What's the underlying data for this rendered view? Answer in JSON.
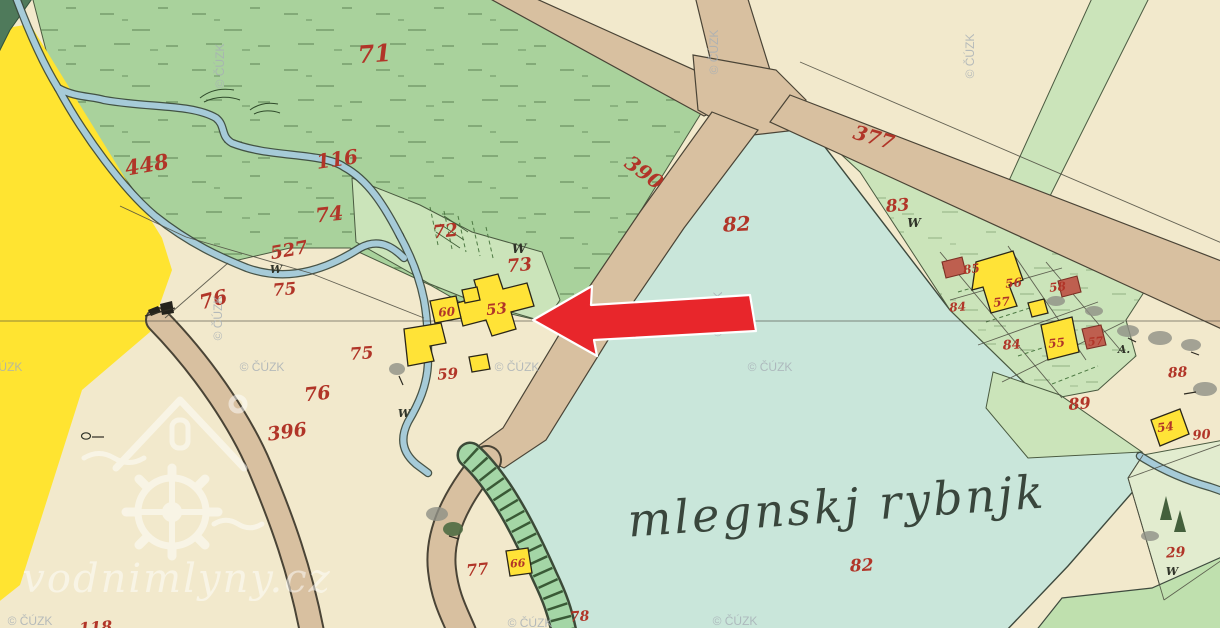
{
  "map": {
    "pond_name": "mlegnskj rybnjk",
    "type_note": "historic hand-colored cadastral map sheet"
  },
  "labels": [
    {
      "t": "71",
      "x": 375,
      "y": 62,
      "s": 24,
      "r": -4
    },
    {
      "t": "448",
      "x": 148,
      "y": 172,
      "s": 21,
      "r": -10
    },
    {
      "t": "116",
      "x": 338,
      "y": 166,
      "s": 20,
      "r": -8
    },
    {
      "t": "74",
      "x": 330,
      "y": 221,
      "s": 20,
      "r": -6
    },
    {
      "t": "527",
      "x": 290,
      "y": 256,
      "s": 18,
      "r": -10
    },
    {
      "t": "72",
      "x": 446,
      "y": 237,
      "s": 18,
      "r": -6
    },
    {
      "t": "W",
      "x": 519,
      "y": 253,
      "s": 13,
      "r": 0,
      "c": "ink"
    },
    {
      "t": "73",
      "x": 520,
      "y": 271,
      "s": 18,
      "r": -5
    },
    {
      "t": "390",
      "x": 640,
      "y": 178,
      "s": 20,
      "r": 36
    },
    {
      "t": "377",
      "x": 872,
      "y": 144,
      "s": 20,
      "r": 16
    },
    {
      "t": "82",
      "x": 737,
      "y": 231,
      "s": 20,
      "r": -3
    },
    {
      "t": "83",
      "x": 898,
      "y": 211,
      "s": 17,
      "r": -5
    },
    {
      "t": "W",
      "x": 914,
      "y": 227,
      "s": 12,
      "r": 0,
      "c": "ink"
    },
    {
      "t": "76",
      "x": 215,
      "y": 306,
      "s": 20,
      "r": -14
    },
    {
      "t": "W",
      "x": 276,
      "y": 273,
      "s": 11,
      "r": 0,
      "c": "ink"
    },
    {
      "t": "75",
      "x": 285,
      "y": 295,
      "s": 17,
      "r": -5
    },
    {
      "t": "75",
      "x": 362,
      "y": 359,
      "s": 17,
      "r": -4
    },
    {
      "t": "76",
      "x": 318,
      "y": 400,
      "s": 19,
      "r": -6
    },
    {
      "t": "396",
      "x": 288,
      "y": 438,
      "s": 19,
      "r": -8
    },
    {
      "t": "W",
      "x": 404,
      "y": 417,
      "s": 11,
      "r": 0,
      "c": "ink"
    },
    {
      "t": "60",
      "x": 447,
      "y": 316,
      "s": 12,
      "r": -4
    },
    {
      "t": "53",
      "x": 497,
      "y": 314,
      "s": 15,
      "r": -6
    },
    {
      "t": "59",
      "x": 448,
      "y": 379,
      "s": 15,
      "r": -4
    },
    {
      "t": "85",
      "x": 972,
      "y": 273,
      "s": 12,
      "r": -8
    },
    {
      "t": "56",
      "x": 1014,
      "y": 287,
      "s": 12,
      "r": -6
    },
    {
      "t": "58",
      "x": 1058,
      "y": 291,
      "s": 12,
      "r": -6
    },
    {
      "t": "57",
      "x": 1002,
      "y": 306,
      "s": 12,
      "r": -6
    },
    {
      "t": "84",
      "x": 958,
      "y": 311,
      "s": 12,
      "r": -4
    },
    {
      "t": "84",
      "x": 1012,
      "y": 349,
      "s": 13,
      "r": -4
    },
    {
      "t": "55",
      "x": 1057,
      "y": 347,
      "s": 12,
      "r": -6
    },
    {
      "t": "57",
      "x": 1096,
      "y": 345,
      "s": 11,
      "r": -6
    },
    {
      "t": "A.",
      "x": 1124,
      "y": 353,
      "s": 11,
      "r": 0,
      "c": "ink"
    },
    {
      "t": "88",
      "x": 1178,
      "y": 377,
      "s": 14,
      "r": -4
    },
    {
      "t": "89",
      "x": 1080,
      "y": 409,
      "s": 16,
      "r": -5
    },
    {
      "t": "54",
      "x": 1166,
      "y": 431,
      "s": 12,
      "r": -8
    },
    {
      "t": "90",
      "x": 1202,
      "y": 439,
      "s": 13,
      "r": -5
    },
    {
      "t": "29",
      "x": 1176,
      "y": 557,
      "s": 14,
      "r": -4
    },
    {
      "t": "W",
      "x": 1172,
      "y": 575,
      "s": 11,
      "r": 0,
      "c": "ink"
    },
    {
      "t": "77",
      "x": 478,
      "y": 575,
      "s": 16,
      "r": -6
    },
    {
      "t": "66",
      "x": 518,
      "y": 567,
      "s": 11,
      "r": -4
    },
    {
      "t": "78",
      "x": 580,
      "y": 621,
      "s": 14,
      "r": -4
    },
    {
      "t": "82",
      "x": 862,
      "y": 571,
      "s": 17,
      "r": -3
    },
    {
      "t": "118",
      "x": 96,
      "y": 633,
      "s": 16,
      "r": -4
    }
  ],
  "watermarks": {
    "brand": "vodnimlyny.cz",
    "copyright_text": "© ČÚZK",
    "copyright_positions": [
      {
        "x": 224,
        "y": 66,
        "r": -90
      },
      {
        "x": 718,
        "y": 52,
        "r": -90
      },
      {
        "x": 974,
        "y": 56,
        "r": -90
      },
      {
        "x": 222,
        "y": 318,
        "r": -90
      },
      {
        "x": 722,
        "y": 314,
        "r": -90
      },
      {
        "x": 0,
        "y": 371,
        "r": 0
      },
      {
        "x": 262,
        "y": 371,
        "r": 0
      },
      {
        "x": 517,
        "y": 371,
        "r": 0
      },
      {
        "x": 770,
        "y": 371,
        "r": 0
      },
      {
        "x": 30,
        "y": 625,
        "r": 0
      },
      {
        "x": 530,
        "y": 627,
        "r": 0
      },
      {
        "x": 735,
        "y": 625,
        "r": 0
      }
    ]
  },
  "highlight_arrow": {
    "direction": "left",
    "points_at": "building 53 (mill site)"
  },
  "colors": {
    "background": "#F2E9CC",
    "meadow": "#A9D29C",
    "parcel_green": "#CBE4BA",
    "pond": "#C9E6DA",
    "stream": "#A6CBD8",
    "road": "#D8C0A0",
    "field_yellow": "#FFE431",
    "building_yellow": "#FFE337",
    "building_red": "#BE5F4F",
    "number_red": "#B13528",
    "ink": "#2F3328",
    "line": "#4A4436",
    "arrow_red": "#E8262B",
    "watermark_gray": "#A7AFB6"
  }
}
